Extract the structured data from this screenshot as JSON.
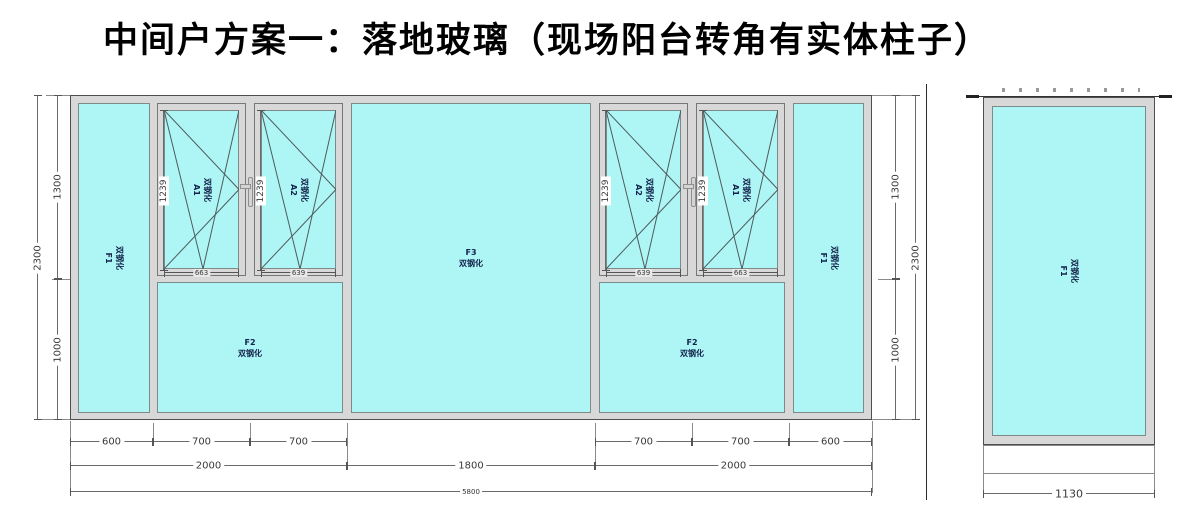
{
  "title": "中间户方案一：落地玻璃（现场阳台转角有实体柱子）",
  "colors": {
    "glass": "#aef6f6",
    "frame": "#d8d8d8",
    "line": "#6a6a6a"
  },
  "main": {
    "panels": {
      "f1_left": {
        "id": "F1",
        "material": "双钢化"
      },
      "a1_left": {
        "id": "A1",
        "material": "双钢化",
        "height": "1239",
        "glass_width": "663"
      },
      "a2_left": {
        "id": "A2",
        "material": "双钢化",
        "height": "1239",
        "glass_width": "639"
      },
      "f2_left": {
        "id": "F2",
        "material": "双钢化"
      },
      "f3": {
        "id": "F3",
        "material": "双钢化"
      },
      "a2_right": {
        "id": "A2",
        "material": "双钢化",
        "height": "1239",
        "glass_width": "639"
      },
      "a1_right": {
        "id": "A1",
        "material": "双钢化",
        "height": "1239",
        "glass_width": "663"
      },
      "f2_right": {
        "id": "F2",
        "material": "双钢化"
      },
      "f1_right": {
        "id": "F1",
        "material": "双钢化"
      }
    },
    "dims": {
      "left_upper": "1300",
      "left_lower": "1000",
      "left_total": "2300",
      "right_upper": "1300",
      "right_lower": "1000",
      "right_total": "2300",
      "bottom_row1": [
        "600",
        "700",
        "700",
        "700",
        "700",
        "600"
      ],
      "bottom_row2": [
        "2000",
        "1800",
        "2000"
      ],
      "bottom_total": "5800"
    }
  },
  "side": {
    "panel": {
      "id": "F1",
      "material": "双钢化"
    },
    "width": "1130"
  }
}
